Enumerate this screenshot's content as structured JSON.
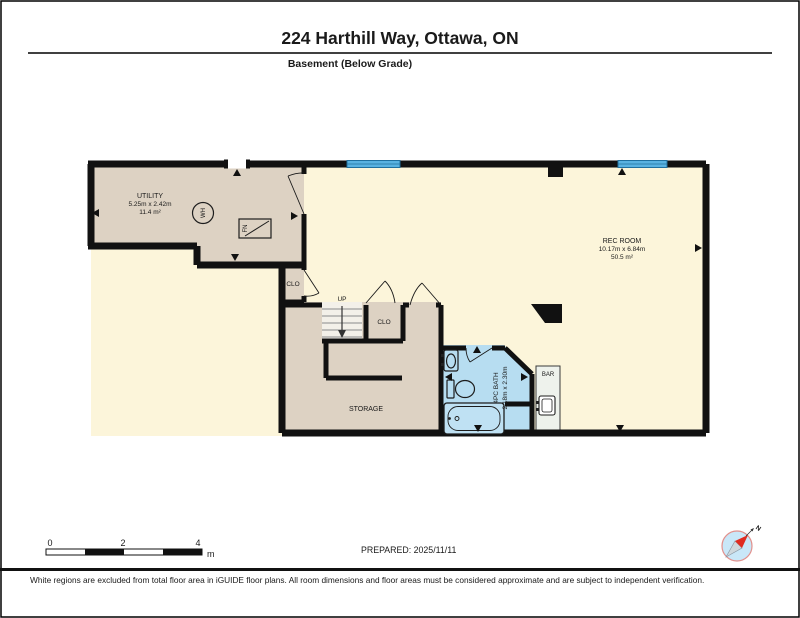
{
  "header": {
    "title": "224 Harthill Way, Ottawa, ON",
    "floor": "Basement (Below Grade)"
  },
  "rooms": {
    "utility": {
      "name": "UTILITY",
      "dims": "5.25m x 2.42m",
      "area": "11.4 m²"
    },
    "rec": {
      "name": "REC ROOM",
      "dims": "10.17m x 6.84m",
      "area": "50.5 m²"
    },
    "storage": {
      "name": "STORAGE"
    },
    "bath": {
      "name": "4PC BATH",
      "dims": "2.18m x 2.30m"
    },
    "bar": {
      "name": "BAR"
    },
    "closet_a": {
      "name": "CLO"
    },
    "closet_b": {
      "name": "CLO"
    },
    "stairs": {
      "label": "UP"
    }
  },
  "fixtures": {
    "water_heater": "WH",
    "furnace": "FN"
  },
  "compass": {
    "north": "N"
  },
  "scale_bar": {
    "ticks": [
      "0",
      "2",
      "4"
    ],
    "unit": "m"
  },
  "meta": {
    "prepared": "PREPARED: 2025/11/11"
  },
  "footer": {
    "disclaimer": "White regions are excluded from total floor area in iGUIDE floor plans. All room dimensions and floor areas must be considered approximate and are subject to independent verification."
  },
  "colors": {
    "wall": "#111111",
    "rec_floor": "#fcf5da",
    "utility_floor": "#ddd2c3",
    "bath_floor": "#b7ddf1",
    "window": "#59b2e1",
    "window_edge": "#20709f",
    "stairs": "#f3f0e9",
    "bar": "#eef2ec",
    "compass_fill": "#c9e7f8",
    "compass_ring": "#e2908c",
    "needle_red": "#e02b20",
    "needle_gray": "#cfd8dd"
  }
}
